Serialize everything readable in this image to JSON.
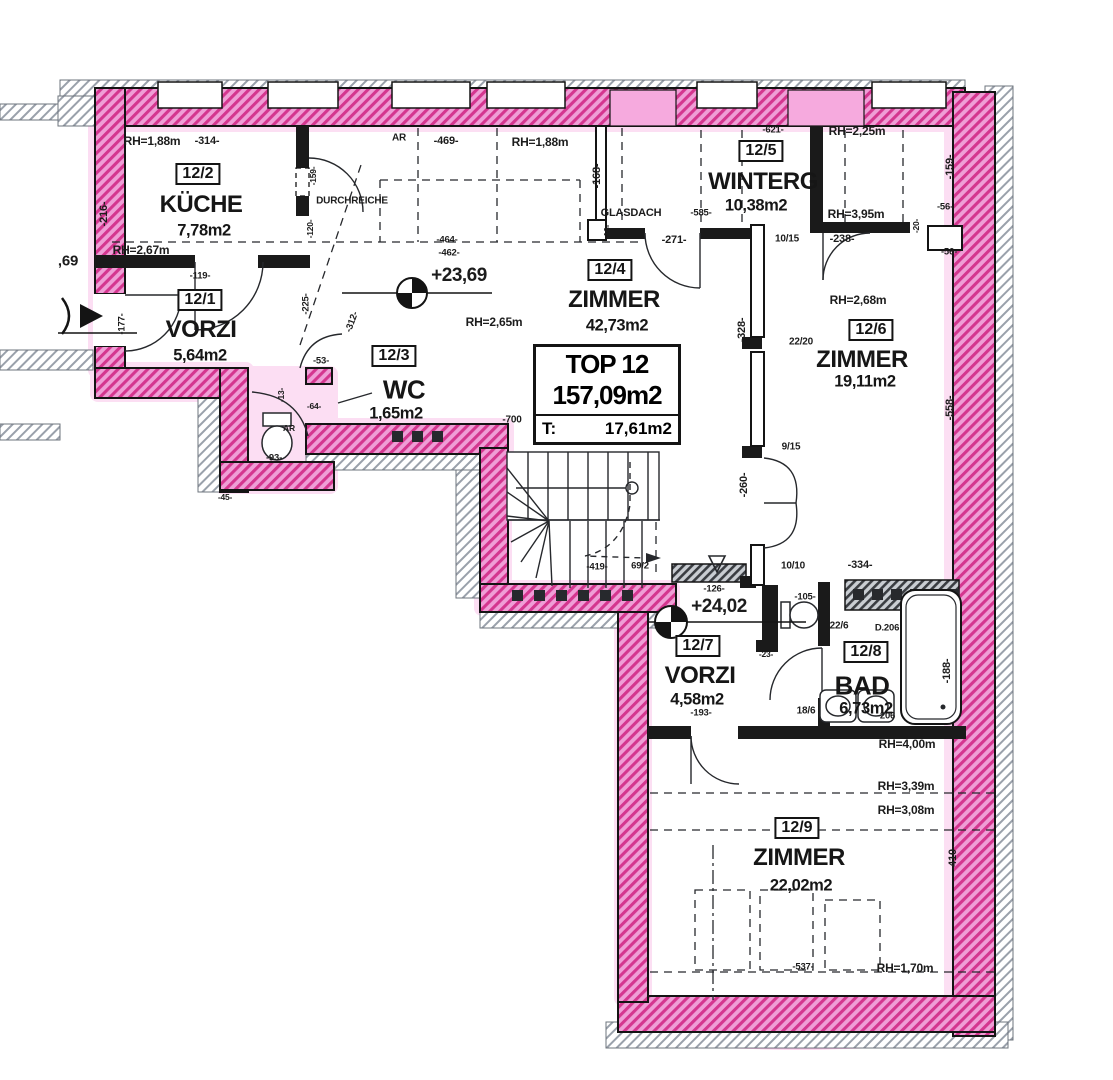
{
  "summary": {
    "unit": "TOP 12",
    "area": "157,09m2",
    "terrace_label": "T:",
    "terrace_value": "17,61m2"
  },
  "rooms": [
    {
      "tag": "12/1",
      "name": "VORZI",
      "area": "5,64m2"
    },
    {
      "tag": "12/2",
      "name": "KÜCHE",
      "area": "7,78m2"
    },
    {
      "tag": "12/3",
      "name": "WC",
      "area": "1,65m2"
    },
    {
      "tag": "12/4",
      "name": "ZIMMER",
      "area": "42,73m2"
    },
    {
      "tag": "12/5",
      "name": "WINTERG",
      "area": "10,38m2"
    },
    {
      "tag": "12/6",
      "name": "ZIMMER",
      "area": "19,11m2"
    },
    {
      "tag": "12/7",
      "name": "VORZI",
      "area": "4,58m2"
    },
    {
      "tag": "12/8",
      "name": "BAD",
      "area": "6,73m2"
    },
    {
      "tag": "12/9",
      "name": "ZIMMER",
      "area": "22,02m2"
    }
  ],
  "levels": [
    {
      "text": "+23,69"
    },
    {
      "text": "+24,02"
    }
  ],
  "annotations": [
    {
      "text": "RH=1,88m"
    },
    {
      "text": "-314-"
    },
    {
      "text": "-216-"
    },
    {
      "text": "RH=2,67m"
    },
    {
      "text": "-119-"
    },
    {
      "text": "AR"
    },
    {
      "text": "-469-"
    },
    {
      "text": "RH=1,88m"
    },
    {
      "text": "-168-"
    },
    {
      "text": "GLASDACH"
    },
    {
      "text": "-585-"
    },
    {
      "text": "-16-"
    },
    {
      "text": "-271-"
    },
    {
      "text": "-621-"
    },
    {
      "text": "RH=2,25m"
    },
    {
      "text": "RH=3,95m"
    },
    {
      "text": "10/15"
    },
    {
      "text": "-238-"
    },
    {
      "text": "-159-"
    },
    {
      "text": "-56-"
    },
    {
      "text": "-56-"
    },
    {
      "text": "-20-"
    },
    {
      "text": "DURCHREICHE"
    },
    {
      "text": "-159-"
    },
    {
      "text": "-120-"
    },
    {
      "text": "-225-"
    },
    {
      "text": "-312-"
    },
    {
      "text": "-464-"
    },
    {
      "text": "-462-"
    },
    {
      "text": "RH=2,65m"
    },
    {
      "text": "-53-"
    },
    {
      "text": "-13-"
    },
    {
      "text": "-64-"
    },
    {
      "text": "AR"
    },
    {
      "text": "-93-"
    },
    {
      "text": "-700"
    },
    {
      "text": "-328-"
    },
    {
      "text": "22/20"
    },
    {
      "text": "RH=2,68m"
    },
    {
      "text": "-558-"
    },
    {
      "text": "9/15"
    },
    {
      "text": "-260-"
    },
    {
      "text": "10/10"
    },
    {
      "text": "-334-"
    },
    {
      "text": "-419-"
    },
    {
      "text": "69/2"
    },
    {
      "text": "-126-"
    },
    {
      "text": "-105-"
    },
    {
      "text": "22/6"
    },
    {
      "text": "D.206"
    },
    {
      "text": "-23-"
    },
    {
      "text": "18/6"
    },
    {
      "text": "-206"
    },
    {
      "text": "-188-"
    },
    {
      "text": "-193-"
    },
    {
      "text": "RH=4,00m"
    },
    {
      "text": "RH=3,39m"
    },
    {
      "text": "RH=3,08m"
    },
    {
      "text": "-410-"
    },
    {
      "text": "-537-"
    },
    {
      "text": "RH=1,70m"
    },
    {
      "text": ",69"
    },
    {
      "text": "-177-"
    },
    {
      "text": "-45-"
    }
  ],
  "colors": {
    "wall_pink": "#ef9ed6",
    "wall_pink_line": "#d4368f",
    "highlight_pink": "#fac4ea",
    "old_wall_gray": "#9aa1ab",
    "ink": "#141414"
  }
}
